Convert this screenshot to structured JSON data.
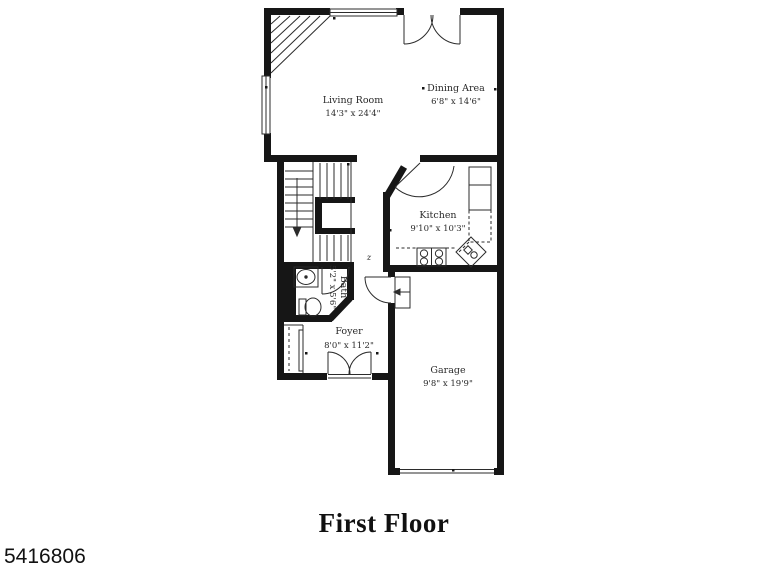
{
  "plan": {
    "title": "First Floor",
    "photo_id": "5416806",
    "stair_note": "z",
    "rooms": {
      "living_room": {
        "name": "Living Room",
        "dims": "14'3\" x 24'4\""
      },
      "dining_area": {
        "name": "Dining Area",
        "dims": "6'8\" x 14'6\""
      },
      "kitchen": {
        "name": "Kitchen",
        "dims": "9'10\" x 10'3\""
      },
      "bath": {
        "name": "Bath",
        "dims": "5'2\" x 5'6\""
      },
      "foyer": {
        "name": "Foyer",
        "dims": "8'0\" x 11'2\""
      },
      "garage": {
        "name": "Garage",
        "dims": "9'8\" x 19'9\""
      }
    },
    "colors": {
      "wall": "#161616",
      "line": "#2b2b2b",
      "text": "#2a2a2a",
      "background": "#ffffff"
    }
  }
}
